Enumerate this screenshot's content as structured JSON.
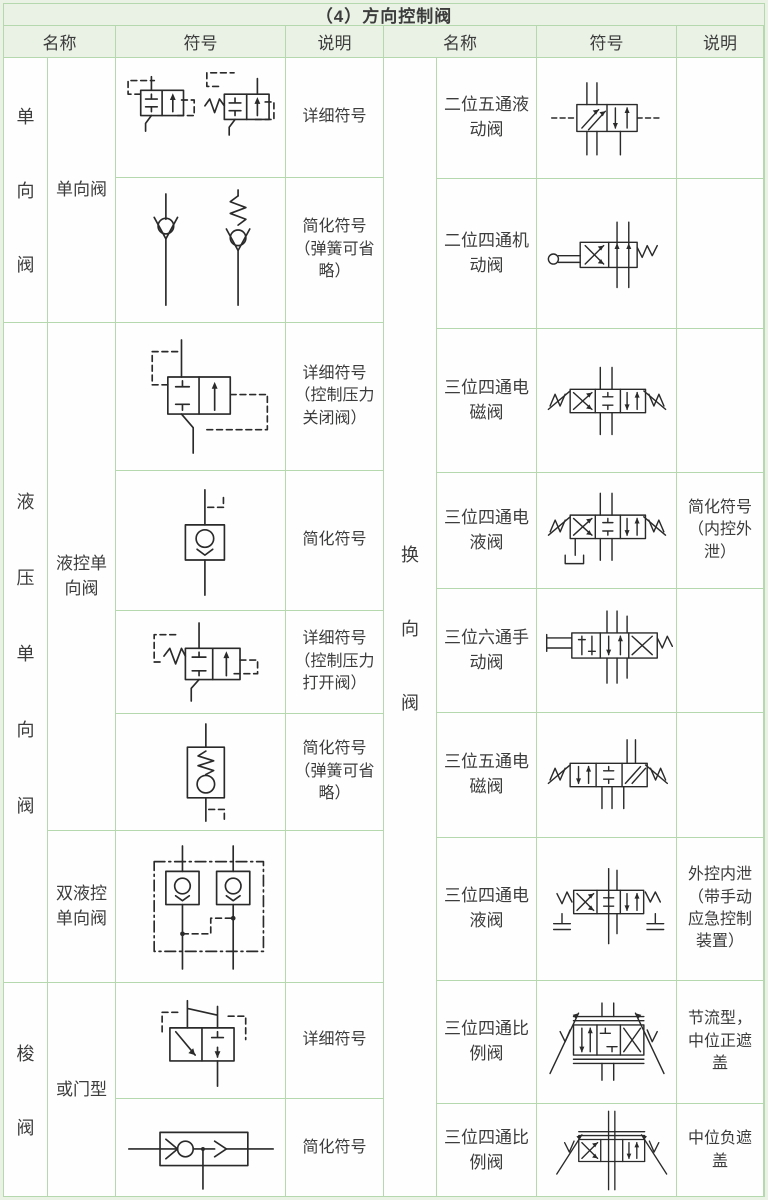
{
  "title": "（4）方向控制阀",
  "headers": {
    "name": "名称",
    "symbol": "符号",
    "desc": "说明"
  },
  "colors": {
    "page_background": "#e9f2e5",
    "border": "#b6d8ae",
    "header_background": "#e9f2e5",
    "cell_background": "#fdfefd",
    "text": "#3c3c3c",
    "symbol_line": "#2a2a2a"
  },
  "left": {
    "groups": [
      {
        "label": "单向阀",
        "chars": [
          "单",
          "向",
          "阀"
        ]
      },
      {
        "label": "液压单向阀",
        "chars": [
          "液",
          "压",
          "单",
          "向",
          "阀"
        ]
      },
      {
        "label": "梭阀",
        "chars": [
          "梭",
          "阀"
        ]
      }
    ],
    "subnames": [
      {
        "label": "单向阀"
      },
      {
        "label": "液控单向阀"
      },
      {
        "label": "双液控单向阀"
      },
      {
        "label": "或门型"
      }
    ],
    "rows": [
      {
        "symbol": "check-valve-detailed",
        "desc": "详细符号"
      },
      {
        "symbol": "check-valve-simplified",
        "desc": "简化符号（弹簧可省略）"
      },
      {
        "symbol": "pilot-check-detailed-close",
        "desc": "详细符号（控制压力关闭阀）"
      },
      {
        "symbol": "pilot-check-simplified",
        "desc": "简化符号"
      },
      {
        "symbol": "pilot-check-detailed-open",
        "desc": "详细符号（控制压力打开阀）"
      },
      {
        "symbol": "pilot-check-simplified-spring",
        "desc": "简化符号（弹簧可省略）"
      },
      {
        "symbol": "double-pilot-check",
        "desc": ""
      },
      {
        "symbol": "shuttle-valve-detailed",
        "desc": "详细符号"
      },
      {
        "symbol": "shuttle-valve-simplified",
        "desc": "简化符号"
      }
    ]
  },
  "right": {
    "group": {
      "label": "换向阀",
      "chars": [
        "换",
        "向",
        "阀"
      ]
    },
    "rows": [
      {
        "name": "二位五通液动阀",
        "symbol": "valve-2pos-5way-hydraulic",
        "desc": ""
      },
      {
        "name": "二位四通机动阀",
        "symbol": "valve-2pos-4way-mechanical",
        "desc": ""
      },
      {
        "name": "三位四通电磁阀",
        "symbol": "valve-3pos-4way-solenoid",
        "desc": ""
      },
      {
        "name": "三位四通电液阀",
        "symbol": "valve-3pos-4way-electrohydraulic",
        "desc": "简化符号（内控外泄）"
      },
      {
        "name": "三位六通手动阀",
        "symbol": "valve-3pos-6way-manual",
        "desc": ""
      },
      {
        "name": "三位五通电磁阀",
        "symbol": "valve-3pos-5way-solenoid",
        "desc": ""
      },
      {
        "name": "三位四通电液阀",
        "symbol": "valve-3pos-4way-electrohydraulic-manual-override",
        "desc": "外控内泄（带手动应急控制装置）"
      },
      {
        "name": "三位四通比例阀",
        "symbol": "valve-3pos-4way-proportional-throttle",
        "desc": "节流型，中位正遮盖"
      },
      {
        "name": "三位四通比例阀",
        "symbol": "valve-3pos-4way-proportional-negative",
        "desc": "中位负遮盖"
      }
    ]
  }
}
